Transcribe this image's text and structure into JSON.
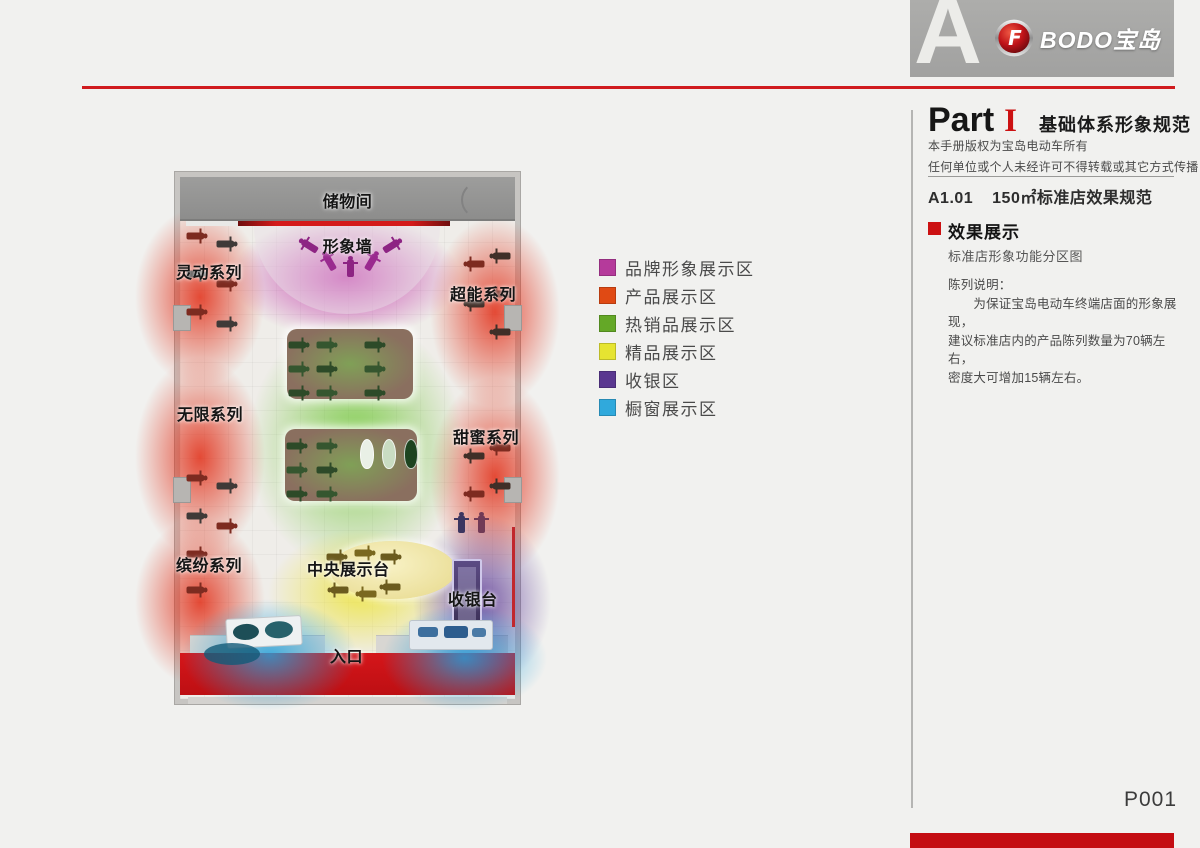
{
  "page": {
    "page_number": "P001",
    "accent_red": "#cc1112",
    "background": "#f1f1ef"
  },
  "header": {
    "section_letter": "A",
    "brand_name": "BODO宝岛",
    "emblem_glyph": "F"
  },
  "sidebar": {
    "part_label": "Part",
    "part_numeral": "I",
    "part_title": "基础体系形象规范",
    "copyright_line1": "本手册版权为宝岛电动车所有",
    "copyright_line2": "任何单位或个人未经许可不得转载或其它方式传播",
    "section_code": "A1.01",
    "section_title": "150㎡标准店效果规范",
    "block_title": "效果展示",
    "block_subtitle": "标准店形象功能分区图",
    "note_title": "陈列说明：",
    "note_line1": "　　为保证宝岛电动车终端店面的形象展现，",
    "note_line2": "建议标准店内的产品陈列数量为70辆左右，",
    "note_line3": "密度大可增加15辆左右。"
  },
  "legend": {
    "items": [
      {
        "label": "品牌形象展示区",
        "color": "#b53a9b"
      },
      {
        "label": "产品展示区",
        "color": "#e04a14"
      },
      {
        "label": "热销品展示区",
        "color": "#64a827"
      },
      {
        "label": "精品展示区",
        "color": "#e6e431"
      },
      {
        "label": "收银区",
        "color": "#5a3790"
      },
      {
        "label": "橱窗展示区",
        "color": "#30a9dc"
      }
    ]
  },
  "floorplan": {
    "labels": {
      "storage": "储物间",
      "image_wall": "形象墙",
      "series_lingdong": "灵动系列",
      "series_chaoneng": "超能系列",
      "series_wuxian": "无限系列",
      "series_tianmi": "甜蜜系列",
      "series_binfen": "缤纷系列",
      "central_stage": "中央展示台",
      "cashier": "收银台",
      "entrance": "入口"
    }
  }
}
